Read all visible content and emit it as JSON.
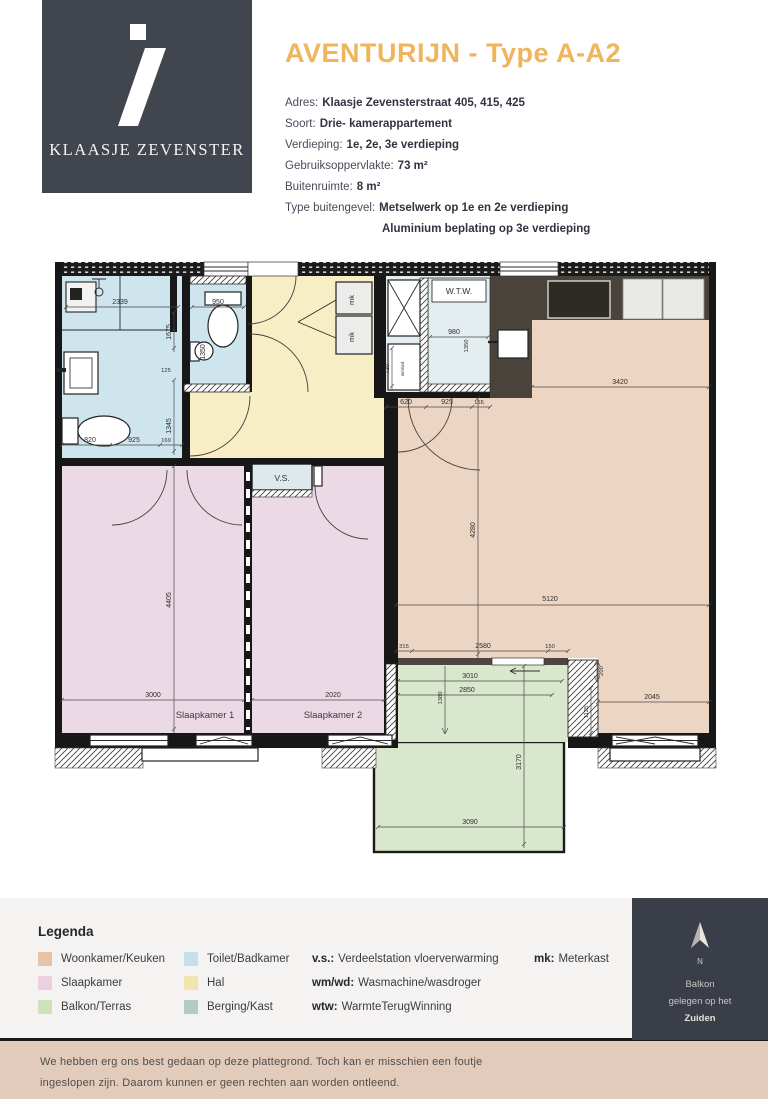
{
  "header": {
    "logo_text": "KLAASJE ZEVENSTER",
    "title": "AVENTURIJN - Type A-A2",
    "title_color": "#f0b55c",
    "info": [
      {
        "label": "Adres:",
        "value": "Klaasje Zevensterstraat 405, 415, 425"
      },
      {
        "label": "Soort:",
        "value": "Drie- kamerappartement"
      },
      {
        "label": "Verdieping:",
        "value": "1e, 2e, 3e verdieping"
      },
      {
        "label": "Gebruiksoppervlakte:",
        "value": "73 m²"
      },
      {
        "label": "Buitenruimte:",
        "value": "8 m²"
      },
      {
        "label": "Type buitengevel:",
        "value": "Metselwerk op 1e en 2e verdieping"
      },
      {
        "label": "",
        "value": "Aluminium beplating op 3e verdieping"
      }
    ]
  },
  "plan": {
    "rooms": {
      "slaapkamer1": "Slaapkamer 1",
      "slaapkamer2": "Slaapkamer 2",
      "vs": "V.S.",
      "wtw": "W.T.W.",
      "mk": "mk",
      "wmwd": "wm/wd"
    },
    "dims": {
      "bath_top": "2339",
      "bath_right_top": "1675",
      "bath_125": "125",
      "bath_right_bottom": "1345",
      "bath_b1": "820",
      "bath_b2": "925",
      "bath_b3": "169",
      "toilet_top": "950",
      "toilet_side": "1350",
      "berging_top": "980",
      "berging_side": "1350",
      "wm_side": "720",
      "entry_1": "620",
      "entry_2": "925",
      "entry_3": "155",
      "kitchen_w": "3420",
      "living_h": "4280",
      "living_w": "5120",
      "s315": "315",
      "s2580": "2580",
      "s150": "150",
      "balc_3010": "3010",
      "balc_2850": "2850",
      "balc_1380": "1380",
      "balc_3170": "3170",
      "balc_3090": "3090",
      "r200": "200",
      "r1125": "1125",
      "r2045": "2045",
      "bed1_h": "4405",
      "bed1_w": "3000",
      "bed2_w": "2020"
    }
  },
  "legend": {
    "heading": "Legenda",
    "swatches": [
      {
        "label": "Woonkamer/Keuken",
        "color": "#e7c3a7"
      },
      {
        "label": "Slaapkamer",
        "color": "#ecd0e0"
      },
      {
        "label": "Balkon/Terras",
        "color": "#cde2b8"
      },
      {
        "label": "Toilet/Badkamer",
        "color": "#c5e0ed"
      },
      {
        "label": "Hal",
        "color": "#f0e5ae"
      },
      {
        "label": "Berging/Kast",
        "color": "#b1ccc3"
      }
    ],
    "abbreviations": [
      {
        "abbr": "v.s.:",
        "text": "Verdeelstation vloerverwarming"
      },
      {
        "abbr": "wm/wd:",
        "text": "Wasmachine/wasdroger"
      },
      {
        "abbr": "wtw:",
        "text": "WarmteTerugWinning"
      },
      {
        "abbr": "mk:",
        "text": "Meterkast"
      }
    ]
  },
  "compass": {
    "north_label": "N",
    "line1": "Balkon",
    "line2": "gelegen op het",
    "line3": "Zuiden"
  },
  "footer": {
    "line1": "We hebben erg ons best gedaan op deze plattegrond. Toch kan er misschien een foutje",
    "line2": "ingeslopen zijn. Daarom kunnen er geen rechten aan worden ontleend."
  }
}
